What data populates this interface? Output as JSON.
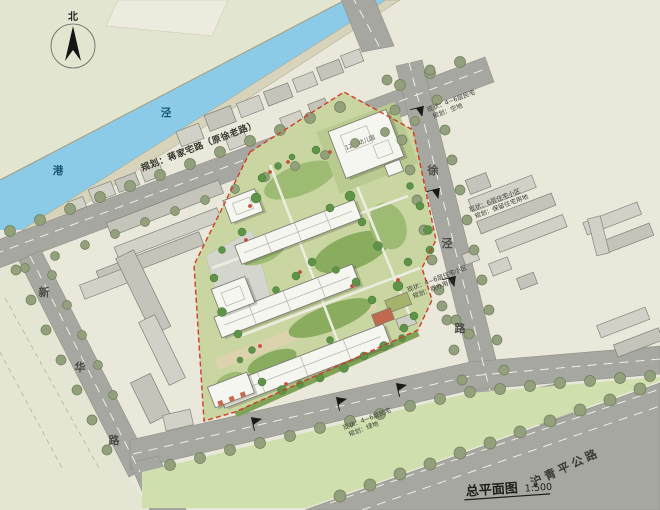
{
  "title": {
    "text": "总平面图",
    "scale": "1:500"
  },
  "compass": {
    "label": "北"
  },
  "river": {
    "char1": "泾",
    "char2": "港"
  },
  "roads": {
    "old_street_label": "规划：蒋家宅路（原徐老路）",
    "west_road_chars": [
      "新",
      "华",
      "路"
    ],
    "east_road_chars": [
      "徐",
      "泾",
      "路"
    ],
    "highway_label": "沪青平公路"
  },
  "annotations": {
    "northeast": {
      "line1": "现状：4~6层民宅",
      "line2": "规划：空地"
    },
    "east": {
      "line1": "现状：6层住宅小区",
      "line2": "规划：保留住宅用地"
    },
    "southeast": {
      "line1": "现状：4~6层住宅小区",
      "line2": "规划：商办用地"
    },
    "south": {
      "line1": "现状：4~6层民宅",
      "line2": "规划：绿地"
    }
  },
  "site": {
    "kindergarten_label": "12班幼儿园"
  },
  "colors": {
    "water": "#8bcbe8",
    "road": "#a7a7a2",
    "site_green": "#c9d6a2",
    "boundary_red": "#d23b28"
  }
}
